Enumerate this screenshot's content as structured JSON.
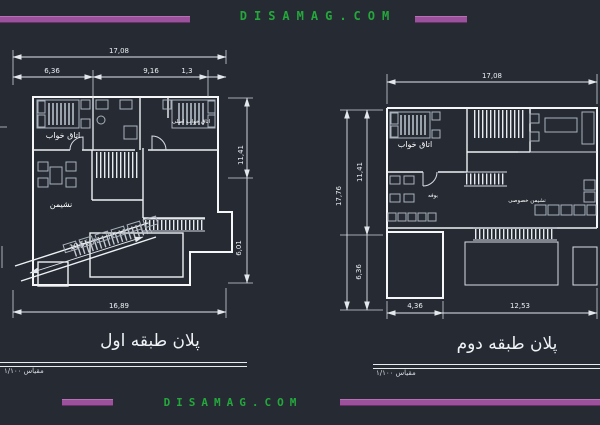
{
  "banner_top": {
    "site": "DISAMAG.COM"
  },
  "banner_bottom": {
    "site": "DISAMAG.COM"
  },
  "colors": {
    "background": "#252a33",
    "linework": "#ffffff",
    "accent_purple": "#9b519b",
    "accent_green": "#25a83b"
  },
  "plan_first": {
    "title": "پلان طبقه اول",
    "scale_note": "مقیاس ۱/۱۰۰",
    "room_labels": {
      "bedroom": "اتاق خواب",
      "master_bedroom": "اتاق خواب اصلی",
      "living": "نشیمن"
    },
    "dimensions": {
      "top_total": "17,08",
      "top_seg_a": "6,36",
      "top_seg_b": "9,16",
      "top_seg_c": "1,3",
      "right_upper": "11,41",
      "right_lower": "6,01",
      "bottom_total": "16,89",
      "ramp": "10,55"
    }
  },
  "plan_second": {
    "title": "پلان طبقه دوم",
    "scale_note": "مقیاس ۱/۱۰۰",
    "room_labels": {
      "bedroom": "اتاق خواب",
      "buffet": "بوفه",
      "private_living": "نشیمن خصوصی"
    },
    "dimensions": {
      "top_total": "17,08",
      "left_total": "17,76",
      "left_upper": "11,41",
      "left_lower": "6,36",
      "bottom_left": "4,36",
      "bottom_right": "12,53"
    }
  }
}
